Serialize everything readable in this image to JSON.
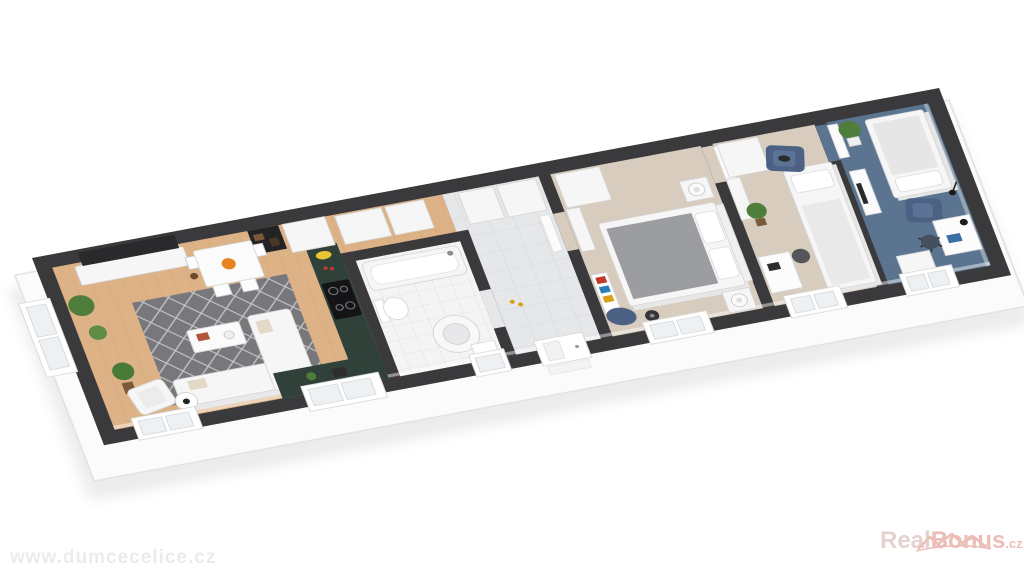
{
  "watermarks": {
    "site": "www.dumcecelice.cz",
    "brand_real": "Real",
    "brand_bonus": "Bonus",
    "brand_tld": ".cz"
  },
  "palette": {
    "background": "#ffffff",
    "shadow": "#ececec",
    "slab": "#fbfbfb",
    "slab-edge": "#e4e4e4",
    "wall": "#3a3a3d",
    "wood-floor": "#dcb286",
    "wood-joint": "#b98a58",
    "rug": "#77777c",
    "rug-line": "#d8d8da",
    "tile-bath": "#f4f4f5",
    "tile-bath-grout": "#e0e0e2",
    "tile-hall": "#e5e7e9",
    "tile-hall-grout": "#d4d6d9",
    "carpet-beige": "#d7ccbd",
    "carpet-blue": "#5b7590",
    "counter-green": "#30413a",
    "white-furniture": "#f6f6f6",
    "furniture-stroke": "#d7d7d7",
    "gray-duvet": "#9b9da1",
    "accent-blue": "#4c6184",
    "plant-green": "#4e7d3c",
    "pot-brown": "#7a5a3a",
    "dark-tv": "#2a2a2c",
    "orange-fruit": "#e8821e",
    "banana-yellow": "#e8c531",
    "glass": "#eef1f3",
    "watermark-gray": "#ebebeb",
    "brand-red": "#d97f74",
    "brand-red-light": "#cda59f"
  },
  "scene": {
    "type": "isometric-3d-floor-plan",
    "rooms": [
      {
        "name": "living-room-with-kitchen",
        "floor": "light wood planks",
        "furniture": [
          "tv",
          "tv-sideboard",
          "media-shelf",
          "dining-table",
          "dining-chairs",
          "fruit-bowl",
          "area-rug",
          "corner-sofa",
          "coffee-table",
          "armchair",
          "side-table",
          "potted-plants",
          "kitchen-counter",
          "induction-cooktop",
          "bananas",
          "display-cabinet",
          "bay-window"
        ]
      },
      {
        "name": "bathroom",
        "floor": "white tile",
        "furniture": [
          "bathtub",
          "toilet",
          "washing-machine",
          "sink",
          "window"
        ]
      },
      {
        "name": "hallway",
        "floor": "gray tile",
        "furniture": [
          "closets",
          "entrance-door",
          "slippers"
        ]
      },
      {
        "name": "master-bedroom",
        "floor": "beige carpet",
        "furniture": [
          "double-bed",
          "nightstands",
          "table-lamps",
          "wardrobe",
          "bookshelf",
          "bean-bag",
          "fan",
          "window"
        ]
      },
      {
        "name": "second-bedroom",
        "floor": "beige carpet",
        "furniture": [
          "single-bed",
          "desk",
          "desk-chair",
          "blue-armchair",
          "wardrobe",
          "potted-plant",
          "window"
        ]
      },
      {
        "name": "study-bedroom",
        "floor": "blue carpet",
        "furniture": [
          "daybed",
          "blue-armchair",
          "desk",
          "office-chair",
          "desk-lamp",
          "drawer-unit",
          "monitor-desk",
          "potted-plant",
          "window"
        ]
      }
    ]
  }
}
